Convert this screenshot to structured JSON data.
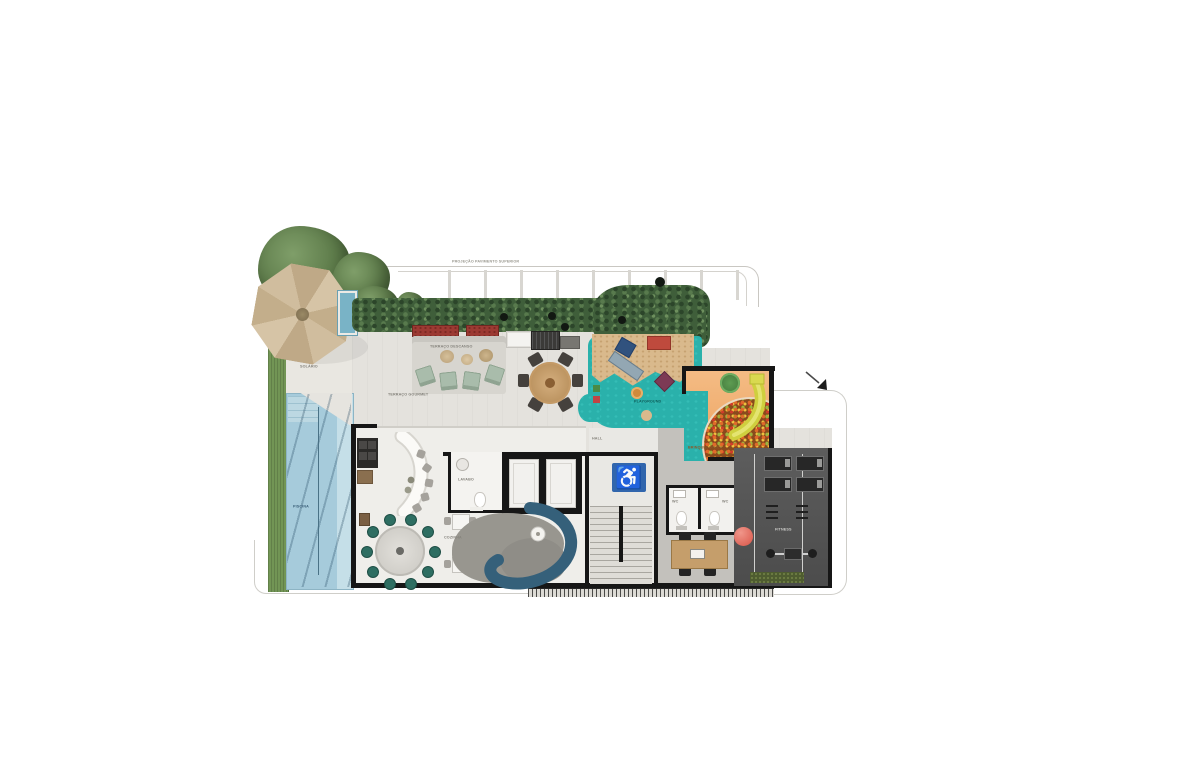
{
  "plan": {
    "labels": {
      "projection_note": "PROJEÇÃO PAVIMENTO SUPERIOR",
      "solarium": "SOLÁRIO",
      "pool": "PISCINA",
      "rest_terrace": "TERRAÇO DESCANSO",
      "gourmet_terrace": "TERRAÇO GOURMET",
      "kitchen": "COZINHA",
      "lavatory": "LAVABO",
      "hall": "HALL",
      "wc_left": "WC",
      "wc_right": "WC",
      "fitness": "FITNESS",
      "playground": "PLAYGROUND",
      "kids_room": "BRINQUEDOTECA"
    },
    "icons": {
      "accessibility_icon": "♿"
    },
    "colors": {
      "deck": "#e4e2dd",
      "interior_floor": "#efeeea",
      "hedge_green": "#3f5e3a",
      "grass_green": "#729555",
      "pool_blue": "#a6cbdb",
      "playground_rubber_teal": "#2ab1ab",
      "sand_tan": "#d9b98c",
      "kids_room_floor_orange": "#eda25f",
      "slide_yellow": "#d8d84a",
      "gym_floor_gray": "#565656",
      "sofa_blue": "#35607a",
      "accessibility_blue": "#3166ad",
      "planter_red": "#9c3a33",
      "wall_black": "#161616",
      "parasol_tan": "#cdb896",
      "wood_tan": "#c8a06c",
      "ball_red": "#e0695f"
    }
  }
}
